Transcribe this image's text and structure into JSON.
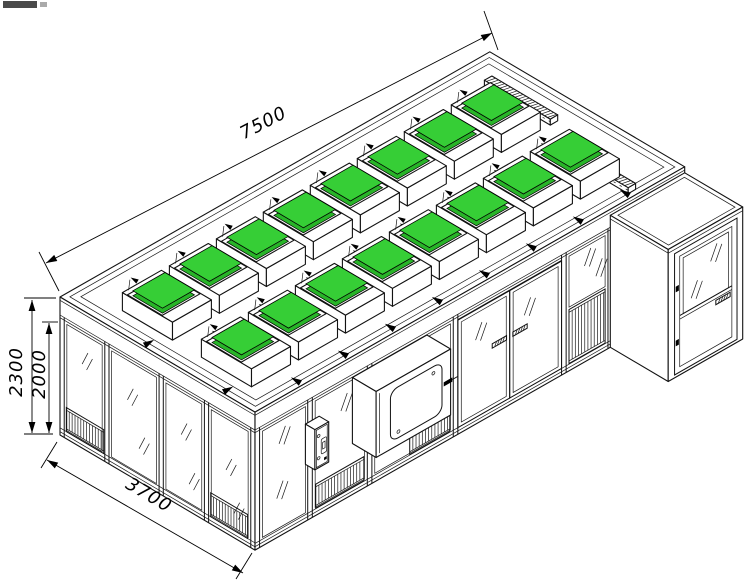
{
  "scene": {
    "subject": "Isometric technical line drawing of a modular clean-room booth with FFU fan-filter units on the roof",
    "background": "#ffffff",
    "line_color": "#121212",
    "filter_green": "#36ce36",
    "filter_green_dark": "#28b428"
  },
  "dimensions": [
    {
      "id": "length",
      "text": "7500"
    },
    {
      "id": "overall_height",
      "text": "2300"
    },
    {
      "id": "wall_height",
      "text": "2000"
    },
    {
      "id": "depth",
      "text": "3700"
    }
  ],
  "ffu_grid": {
    "rows": 2,
    "per_row": 8,
    "row_depth_centers_mm": [
      1050,
      2550
    ],
    "first_center_mm": 900,
    "pitch_mm": 820,
    "housing_mm": {
      "length": 680,
      "depth": 950,
      "height": 300
    },
    "filter_mm": 560
  },
  "features": {
    "roof_light_bars": 2,
    "sliding_door_leaves": 2,
    "pass_box": true,
    "control_panel": true,
    "entry_module_with_door": true,
    "glass_panels_front": 4,
    "glass_panels_end": 4,
    "return_air_grilles": 5
  }
}
